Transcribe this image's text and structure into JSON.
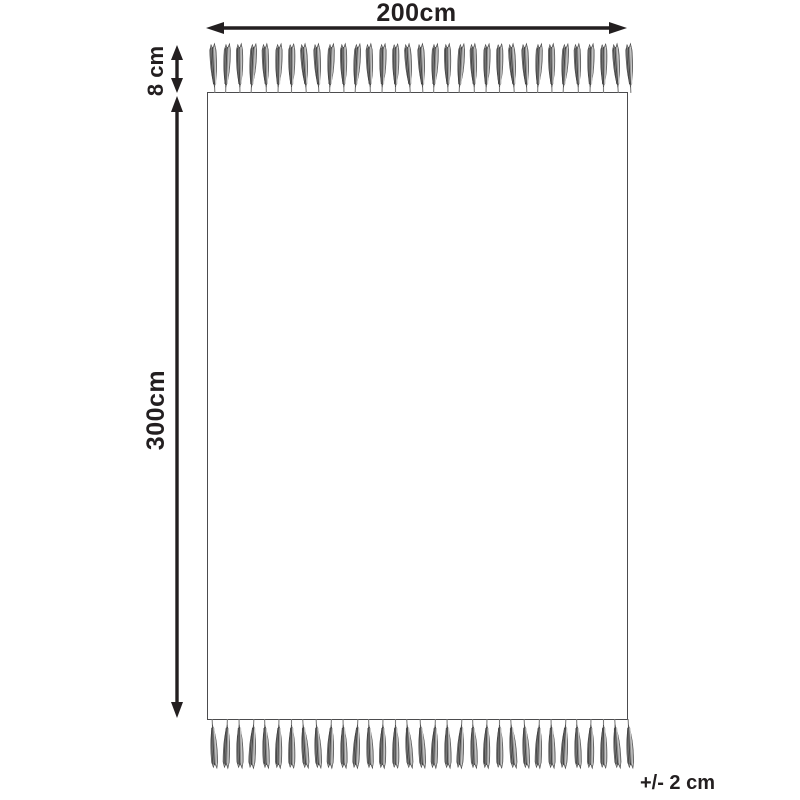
{
  "diagram": {
    "width_label": "200cm",
    "height_label": "300cm",
    "fringe_height_label": "8 cm",
    "tolerance_label": "+/- 2 cm",
    "top_fringe_count": 33,
    "bottom_fringe_count": 33,
    "colors": {
      "line": "#231f20",
      "rug_border": "#4c4c4e",
      "rug_fill": "#ffffff",
      "background": "#ffffff",
      "tassel_mid": "#8e8e8e",
      "tassel_dark": "#414141",
      "tassel_light": "#c6c6c6"
    }
  }
}
